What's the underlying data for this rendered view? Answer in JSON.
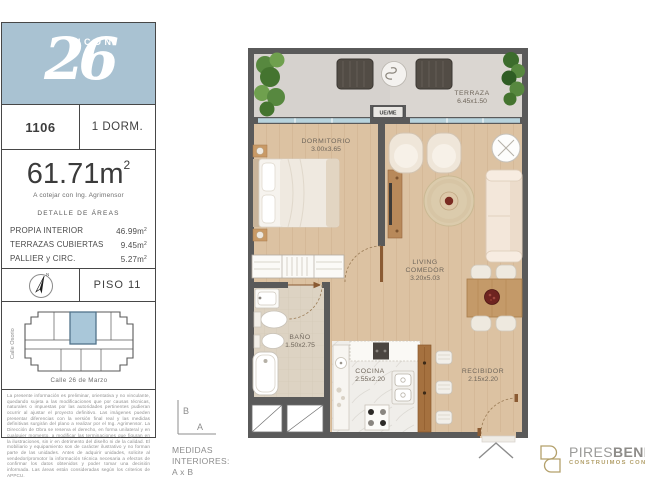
{
  "panel": {
    "logo": {
      "number": "26",
      "name": "ICON"
    },
    "unit": {
      "number": "1106",
      "type": "1 DORM."
    },
    "area": {
      "total_base": "61.71m",
      "total_sup": "2",
      "note": "A cotejar con Ing. Agrimensor",
      "detail_title": "DETALLE DE ÁREAS",
      "rows": [
        {
          "label": "PROPIA INTERIOR",
          "value_base": "46.99m",
          "value_sup": "2"
        },
        {
          "label": "TERRAZAS CUBIERTAS",
          "value_base": "9.45m",
          "value_sup": "2"
        },
        {
          "label": "PALLIER y CIRC.",
          "value_base": "5.27m",
          "value_sup": "2"
        }
      ]
    },
    "floor": {
      "label": "PISO 11",
      "compass_n": "N"
    },
    "keyplan": {
      "street_left": "Calle Osorio",
      "street_bottom": "Calle 26 de Marzo"
    },
    "disclaimer": "La presente información es preliminar, orientativa y no vinculante, quedando sujeta a las modificaciones que por causas técnicas, naturales o impuestas por las autoridades pertinentes pudieran ocurrir al ajustar el proyecto definitivo. Las imágenes pueden presentar diferencias con la versión final real y las medidas definitivas surgirán del plano a realizar por el Ing. Agrimensor. La Dirección de Obra se reserva el derecho, en forma unilateral y en cualquier momento, a modificar las terminaciones que figuran en la ilustraciones, sin ir en detrimento del diseño ni de la calidad. El mobiliario y equipamiento son de carácter ilustrativo y no forman parte de las unidades. Antes de adquirir unidades, solicite al vendedor/promotor la información técnica necesaria a efectos de confirmar los datos obtenidos y poder tomar una decisión informada. Las áreas están consideradas según los criterios de APPCU."
  },
  "measures": {
    "axis_b": "B",
    "axis_a": "A",
    "label": "MEDIDAS INTERIORES: A x B"
  },
  "plan": {
    "labels": {
      "ue_me": "UE/ME"
    },
    "rooms": {
      "terraza": {
        "name": "TERRAZA",
        "dims": "6.45x1.50"
      },
      "dormitorio": {
        "name": "DORMITORIO",
        "dims": "3.00x3.65"
      },
      "living": {
        "line1": "LIVING",
        "line2": "COMEDOR",
        "dims": "3.20x5.03"
      },
      "bano": {
        "name": "BAÑO",
        "dims": "1.50x2.75"
      },
      "cocina": {
        "name": "COCINA",
        "dims": "2.55x2.20"
      },
      "recibidor": {
        "name": "RECIBIDOR",
        "dims": "2.15x2.20"
      }
    }
  },
  "footer": {
    "brand_first": "PIRES",
    "brand_second": "BENLIA",
    "tagline": "CONSTRUIMOS CON EST"
  },
  "colors": {
    "brand_blue": "#a9c2d2",
    "keyplan_highlight": "#a9c7d9",
    "gold": "#b3a06b",
    "wall": "#5a5a5a",
    "wood": "#dcc2a2"
  }
}
